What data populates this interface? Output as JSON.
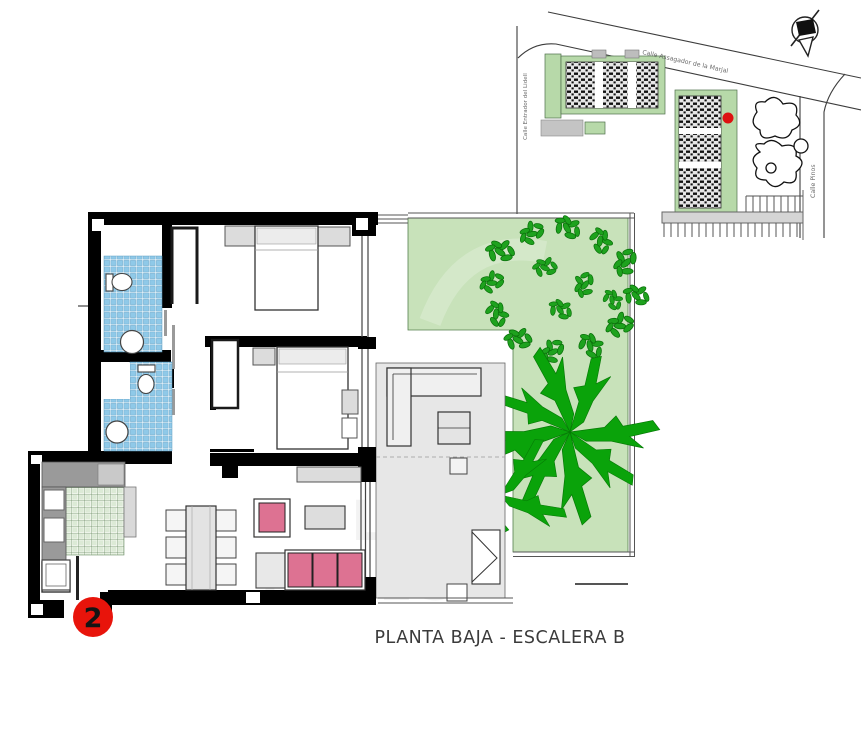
{
  "caption": {
    "text": "PLANTA BAJA - ESCALERA B"
  },
  "unit_marker": {
    "number": "2",
    "color": "#e8140b"
  },
  "site_plan": {
    "streets": [
      {
        "name": "Calle Assagador de la Marjal"
      },
      {
        "name": "Calle Entrador del Lidell"
      },
      {
        "name": "Calle Pinos"
      }
    ],
    "location_marker_color": "#dd1111",
    "green_area_color": "#b7d9a9"
  },
  "floor_plan": {
    "colors": {
      "wall": "#000000",
      "garden_green": "#c8e2ba",
      "tree_canopy_green": "#1ea21e",
      "palm_green": "#0aa30a",
      "bathroom_tile_blue": "#8fc9e8",
      "kitchen_tile_green": "#dcead6",
      "sofa_pink": "#dd7292",
      "terrace_gray": "#e7e7e7",
      "furniture_gray": "#d9d9d9",
      "counter_gray": "#9a9a9a"
    }
  },
  "watermark": {
    "line1": "LAR",
    "line2": "EALES"
  }
}
